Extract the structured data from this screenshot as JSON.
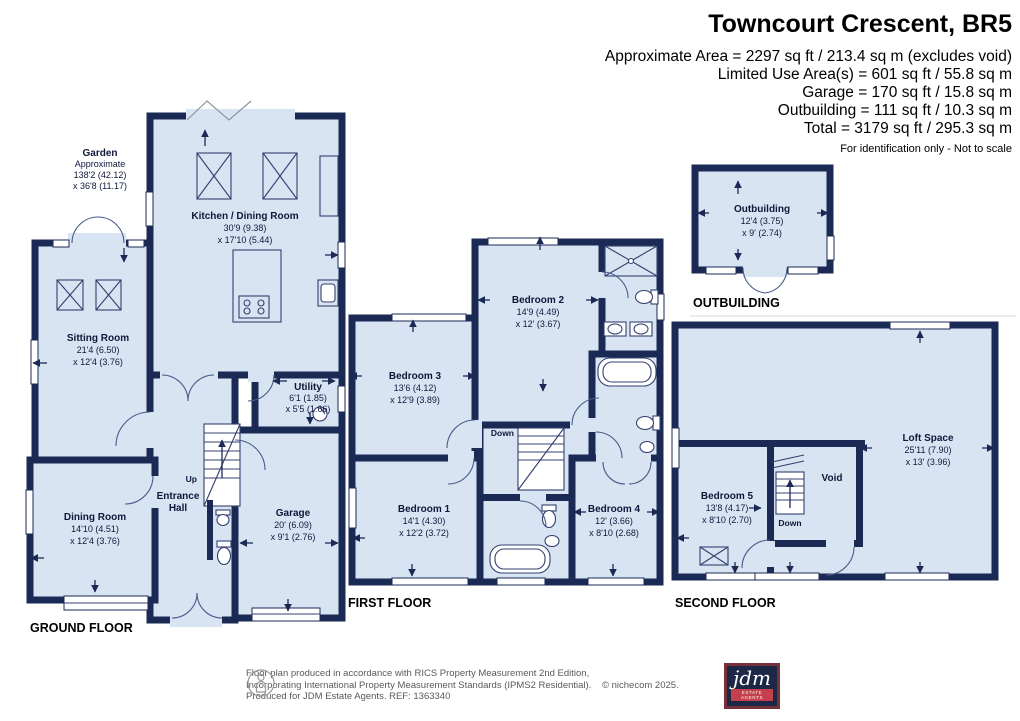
{
  "header": {
    "title": "Towncourt Crescent, BR5",
    "area_lines": [
      "Approximate Area = 2297 sq ft / 213.4 sq m (excludes void)",
      "Limited Use Area(s) = 601 sq ft / 55.8 sq m",
      "Garage = 170 sq ft / 15.8 sq m",
      "Outbuilding = 111 sq ft / 10.3 sq m",
      "Total = 3179 sq ft / 295.3 sq m"
    ],
    "disclaimer": "For identification only - Not to scale"
  },
  "ground_floor": {
    "label": "GROUND FLOOR",
    "garden": {
      "name": "Garden",
      "note": "Approximate",
      "dim1": "138'2 (42.12)",
      "dim2": "x 36'8 (11.17)"
    },
    "kitchen": {
      "name": "Kitchen / Dining Room",
      "dim1": "30'9 (9.38)",
      "dim2": "x 17'10 (5.44)"
    },
    "sitting_room": {
      "name": "Sitting Room",
      "dim1": "21'4 (6.50)",
      "dim2": "x 12'4 (3.76)"
    },
    "dining_room": {
      "name": "Dining Room",
      "dim1": "14'10 (4.51)",
      "dim2": "x 12'4 (3.76)"
    },
    "entrance_hall": {
      "line1": "Entrance",
      "line2": "Hall"
    },
    "utility": {
      "name": "Utility",
      "dim1": "6'1 (1.85)",
      "dim2": "x 5'5 (1.66)"
    },
    "garage": {
      "name": "Garage",
      "dim1": "20' (6.09)",
      "dim2": "x 9'1 (2.76)"
    },
    "stairs": "Up"
  },
  "first_floor": {
    "label": "FIRST FLOOR",
    "bedroom1": {
      "name": "Bedroom 1",
      "dim1": "14'1 (4.30)",
      "dim2": "x 12'2 (3.72)"
    },
    "bedroom2": {
      "name": "Bedroom 2",
      "dim1": "14'9 (4.49)",
      "dim2": "x 12' (3.67)"
    },
    "bedroom3": {
      "name": "Bedroom 3",
      "dim1": "13'6 (4.12)",
      "dim2": "x 12'9 (3.89)"
    },
    "bedroom4": {
      "name": "Bedroom 4",
      "dim1": "12' (3.66)",
      "dim2": "x 8'10 (2.68)"
    },
    "stairs": "Down"
  },
  "second_floor": {
    "label": "SECOND FLOOR",
    "loft": {
      "name": "Loft Space",
      "dim1": "25'11 (7.90)",
      "dim2": "x 13' (3.96)"
    },
    "bedroom5": {
      "name": "Bedroom 5",
      "dim1": "13'8 (4.17)",
      "dim2": "x 8'10 (2.70)"
    },
    "void": "Void",
    "stairs": "Down"
  },
  "outbuilding": {
    "label": "OUTBUILDING",
    "room": {
      "name": "Outbuilding",
      "dim1": "12'4 (3.75)",
      "dim2": "x 9' (2.74)"
    }
  },
  "footer": {
    "line1": "Floor plan produced in accordance with RICS Property Measurement 2nd Edition,",
    "line2": "Incorporating International Property Measurement Standards (IPMS2 Residential).",
    "copyright": "© nichecom 2025.",
    "line3": "Produced for JDM Estate Agents.    REF: 1363340",
    "logo_text": "jdm",
    "logo_subtext": "ESTATE AGENTS"
  },
  "colors": {
    "wall": "#1b2a55",
    "floor": "#d9e4f2",
    "logo_red": "#c4404d"
  }
}
